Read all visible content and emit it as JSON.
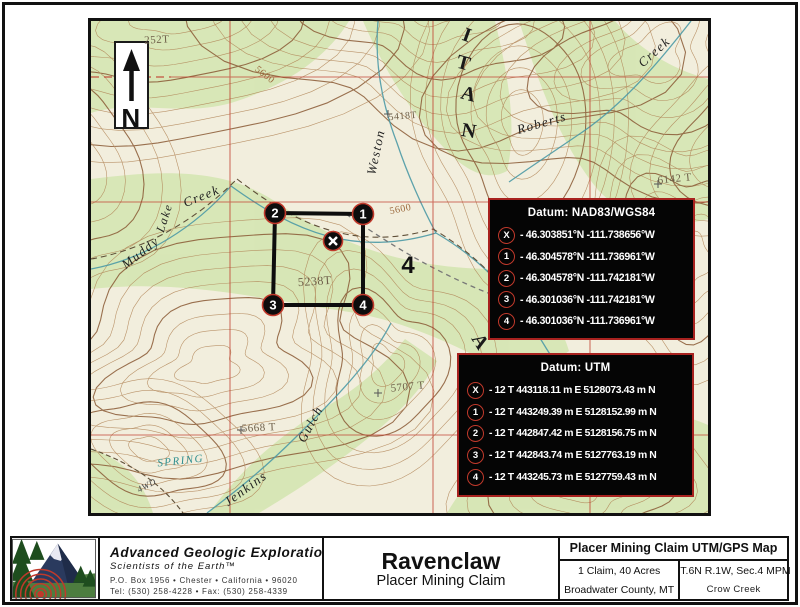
{
  "north_arrow": {
    "label": "N"
  },
  "map_labels": [
    {
      "text": "252T",
      "x": 66,
      "y": 22,
      "size": 11,
      "rot": -3,
      "style": "elev"
    },
    {
      "text": "5600",
      "x": 172,
      "y": 56,
      "size": 10,
      "rot": 38,
      "style": "contour"
    },
    {
      "text": "Weston",
      "x": 289,
      "y": 132,
      "size": 13,
      "rot": -78,
      "style": "creek"
    },
    {
      "text": "5418T",
      "x": 312,
      "y": 98,
      "size": 10,
      "rot": -5,
      "style": "elev"
    },
    {
      "text": "I",
      "x": 374,
      "y": 20,
      "size": 20,
      "rot": 20,
      "style": "forest"
    },
    {
      "text": "T",
      "x": 371,
      "y": 48,
      "size": 20,
      "rot": 15,
      "style": "forest"
    },
    {
      "text": "A",
      "x": 376,
      "y": 79,
      "size": 20,
      "rot": 15,
      "style": "forest"
    },
    {
      "text": "N",
      "x": 377,
      "y": 116,
      "size": 20,
      "rot": 10,
      "style": "forest"
    },
    {
      "text": "A",
      "x": 384,
      "y": 324,
      "size": 20,
      "rot": 58,
      "style": "forest"
    },
    {
      "text": "Roberts",
      "x": 452,
      "y": 106,
      "size": 13,
      "rot": -16,
      "style": "creek"
    },
    {
      "text": "Creek",
      "x": 566,
      "y": 34,
      "size": 13,
      "rot": -42,
      "style": "creek"
    },
    {
      "text": "6142 T",
      "x": 584,
      "y": 161,
      "size": 11,
      "rot": -6,
      "style": "elev"
    },
    {
      "text": "Muddy",
      "x": 52,
      "y": 235,
      "size": 13,
      "rot": -38,
      "style": "creek"
    },
    {
      "text": "Lake",
      "x": 77,
      "y": 198,
      "size": 12,
      "rot": -72,
      "style": "creek"
    },
    {
      "text": "Creek",
      "x": 112,
      "y": 179,
      "size": 13,
      "rot": -22,
      "style": "creek"
    },
    {
      "text": "5238T",
      "x": 224,
      "y": 264,
      "size": 12,
      "rot": -4,
      "style": "elev"
    },
    {
      "text": "5600",
      "x": 310,
      "y": 191,
      "size": 10,
      "rot": -12,
      "style": "contour"
    },
    {
      "text": "5707 T",
      "x": 317,
      "y": 369,
      "size": 11,
      "rot": -6,
      "style": "elev"
    },
    {
      "text": "5668 T",
      "x": 168,
      "y": 410,
      "size": 11,
      "rot": -3,
      "style": "elev"
    },
    {
      "text": "SPRING",
      "x": 90,
      "y": 443,
      "size": 11,
      "rot": -6,
      "style": "spring"
    },
    {
      "text": "4WD",
      "x": 57,
      "y": 467,
      "size": 9,
      "rot": -28,
      "style": "road"
    },
    {
      "text": "Jenkins",
      "x": 157,
      "y": 471,
      "size": 13,
      "rot": -36,
      "style": "creek"
    },
    {
      "text": "Gulch",
      "x": 223,
      "y": 405,
      "size": 13,
      "rot": -62,
      "style": "creek"
    },
    {
      "text": "N",
      "x": 40,
      "y": 106,
      "size": 26,
      "rot": 0,
      "style": "north"
    }
  ],
  "claim": {
    "corners": [
      {
        "label": "2",
        "x": 184,
        "y": 192
      },
      {
        "label": "1",
        "x": 272,
        "y": 193
      },
      {
        "label": "4",
        "x": 272,
        "y": 284
      },
      {
        "label": "3",
        "x": 182,
        "y": 284
      }
    ],
    "center": {
      "label": "X",
      "x": 242,
      "y": 220
    },
    "section_number": {
      "text": "4",
      "x": 317,
      "y": 252
    }
  },
  "datum_boxes": [
    {
      "title": "Datum: NAD83/WGS84",
      "rows": [
        {
          "marker": "X",
          "text": "- 46.303851°N -111.738656°W"
        },
        {
          "marker": "1",
          "text": "- 46.304578°N -111.736961°W"
        },
        {
          "marker": "2",
          "text": "- 46.304578°N -111.742181°W"
        },
        {
          "marker": "3",
          "text": "- 46.301036°N -111.742181°W"
        },
        {
          "marker": "4",
          "text": "- 46.301036°N -111.736961°W"
        }
      ]
    },
    {
      "title": "Datum: UTM",
      "rows": [
        {
          "marker": "X",
          "text": "- 12 T 443118.11 m E 5128073.43 m N"
        },
        {
          "marker": "1",
          "text": "- 12 T 443249.39 m E 5128152.99 m N"
        },
        {
          "marker": "2",
          "text": "- 12 T 442847.42 m E 5128156.75 m N"
        },
        {
          "marker": "3",
          "text": "- 12 T 442843.74 m E 5127763.19 m N"
        },
        {
          "marker": "4",
          "text": "- 12 T 443245.73 m E 5127759.43 m N"
        }
      ]
    }
  ],
  "footer": {
    "company": {
      "name": "Advanced Geologic Exploration, Inc.",
      "tagline": "Scientists of the Earth™",
      "address": "P.O. Box 1956 • Chester • California • 96020",
      "phone": "Tel: (530) 258-4228 • Fax: (530) 258-4339"
    },
    "title_block": {
      "claim_name": "Ravenclaw",
      "subtitle": "Placer Mining Claim"
    },
    "info_table": {
      "header": "Placer Mining Claim UTM/GPS Map",
      "rows": [
        [
          "1 Claim, 40 Acres",
          "T.6N R.1W, Sec.4 MPM"
        ],
        [
          "Broadwater County, MT",
          "Crow Creek"
        ]
      ]
    }
  },
  "colors": {
    "accent_red": "#a8221f",
    "grid_red": "#c0392b",
    "contour_brown": "#b08355",
    "index_contour": "#8a5a35",
    "water_blue": "#4d9aa6",
    "veg_green": "#d6e6b4"
  }
}
